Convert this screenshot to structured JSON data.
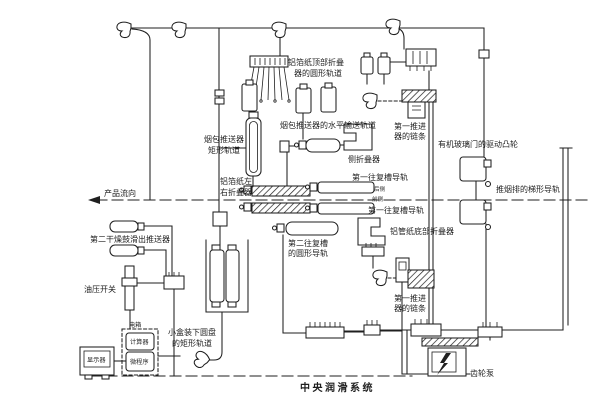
{
  "diagram": {
    "caption": {
      "text": "中央润滑系统"
    },
    "colors": {
      "ink": "#1f1f1f",
      "paper": "#ffffff"
    },
    "icons": {
      "flow_direction": "left-arrow",
      "pump_motor": "lightning-bolt",
      "lube_points": "grease-nozzle"
    },
    "labels": {
      "foil_top_circular_track": {
        "line1": "铝箔纸顶部折叠",
        "line2": "器的圆形轨道"
      },
      "pack_pusher_horizontal_track": {
        "text": "烟包推送器的水平输送轨道"
      },
      "pack_pusher_rect_track": {
        "line1": "烟包推送器",
        "line2": "矩形轨道"
      },
      "side_folder": {
        "text": "侧折叠器"
      },
      "foil_left_right_folder": {
        "line1": "铝箔纸左",
        "line2": "右折叠器"
      },
      "recip_groove_rail_rear": {
        "text": "第一往复槽导轨",
        "side": "后侧"
      },
      "recip_groove_rail_front": {
        "text": "第一往复槽导轨",
        "side": "前侧"
      },
      "recip_groove2_circular_rail": {
        "line1": "第二往复槽",
        "line2": "的圆形导轨"
      },
      "tube_paper_bottom_folder": {
        "text": "铝管纸底部折叠器"
      },
      "pusher1_chain_upper": {
        "line1": "第一推进",
        "line2": "器的链条"
      },
      "pusher1_chain_lower": {
        "line1": "第一推进",
        "line2": "器的链条"
      },
      "plexiglass_door_cam": {
        "text": "有机玻璃门的驱动凸轮"
      },
      "push_row_trapezoid_rail": {
        "text": "推烟排的梯形导轨"
      },
      "dryer2_slideout_pusher": {
        "text": "第二干燥鼓滑出推送器"
      },
      "oil_pressure_switch": {
        "text": "油压开关"
      },
      "electric_box": {
        "text": "电箱"
      },
      "computer_unit": {
        "text": "计算器"
      },
      "display_unit": {
        "text": "显示器"
      },
      "microprogram_unit": {
        "text": "微程序"
      },
      "small_box_disc_rect_track": {
        "line1": "小盒装下圆盘",
        "line2": "的矩形轨道"
      },
      "product_flow": {
        "text": "产品流向"
      },
      "gear_pump": {
        "text": "齿轮泵"
      }
    }
  }
}
